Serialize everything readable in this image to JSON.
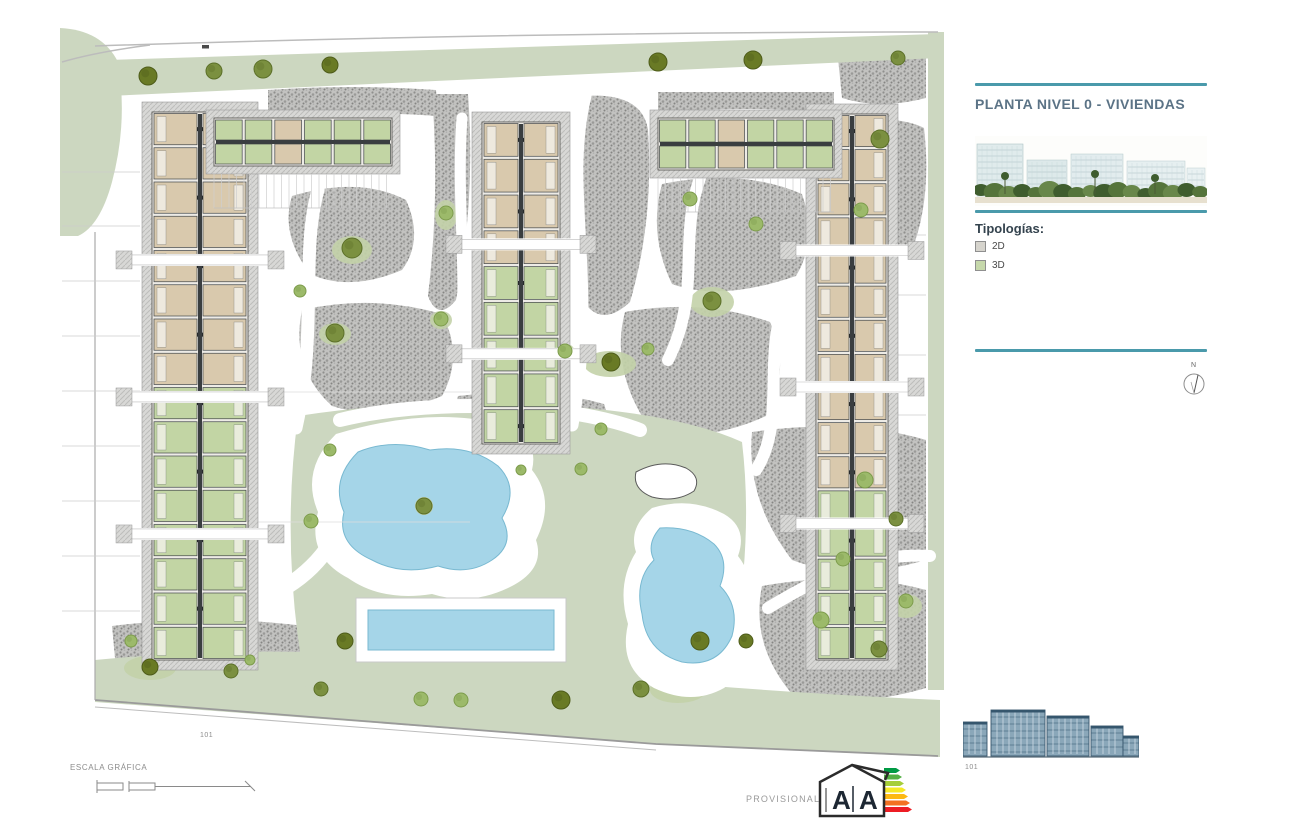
{
  "panel": {
    "title": "PLANTA NIVEL 0 - VIVIENDAS",
    "legend": {
      "heading": "Tipologías:",
      "items": [
        {
          "label": "2D",
          "color": "#d6d4cd"
        },
        {
          "label": "3D",
          "color": "#c6d8ab"
        }
      ]
    },
    "compass_label": "N"
  },
  "footer": {
    "scale_label": "ESCALA GRÁFICA",
    "provisional_label": "PROVISIONAL",
    "energy_letter_left": "A",
    "energy_letter_right": "A",
    "site_ref": "101",
    "elevation_ref": "101"
  },
  "plan": {
    "colors": {
      "teal_rule": "#4a9aab",
      "title_text": "#5b7386",
      "lawn": "#ccd7c0",
      "lawn_island": "#c3d1a8",
      "gravel": "#c2c2c0",
      "pool_water": "#a5d5e8",
      "unit_2d": "#d9c9ad",
      "unit_3d": "#c2d5a4",
      "building_wall": "#3a3e40",
      "elevation_blue": "#8aa7b9"
    }
  }
}
